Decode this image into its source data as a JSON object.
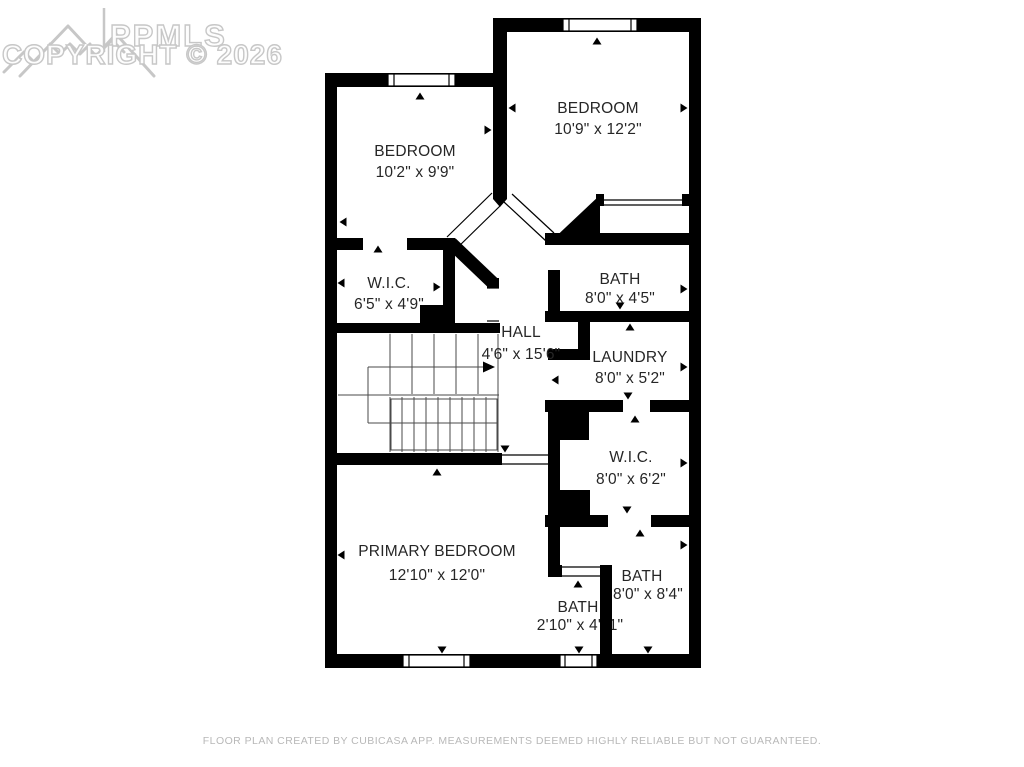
{
  "watermark": {
    "brand": "PPMLS",
    "copyright": "COPYRIGHT © 2026"
  },
  "rooms": [
    {
      "id": "bedroom-top-right",
      "name": "BEDROOM",
      "dimensions": "10'9\" x 12'2\""
    },
    {
      "id": "bedroom-top-left",
      "name": "BEDROOM",
      "dimensions": "10'2\" x 9'9\""
    },
    {
      "id": "wic-left",
      "name": "W.I.C.",
      "dimensions": "6'5\" x 4'9\""
    },
    {
      "id": "hall",
      "name": "HALL",
      "dimensions": "4'6\" x 15'6\""
    },
    {
      "id": "bath-upper",
      "name": "BATH",
      "dimensions": "8'0\" x 4'5\""
    },
    {
      "id": "laundry",
      "name": "LAUNDRY",
      "dimensions": "8'0\" x 5'2\""
    },
    {
      "id": "wic-right",
      "name": "W.I.C.",
      "dimensions": "8'0\" x 6'2\""
    },
    {
      "id": "primary-bedroom",
      "name": "PRIMARY BEDROOM",
      "dimensions": "12'10\" x 12'0\""
    },
    {
      "id": "bath-lower-right",
      "name": "BATH",
      "dimensions": "8'0\" x 8'4\""
    },
    {
      "id": "bath-small",
      "name": "BATH",
      "dimensions": "2'10\" x 4'11\""
    }
  ],
  "footer": {
    "disclaimer": "FLOOR PLAN CREATED BY CUBICASA APP. MEASUREMENTS DEEMED HIGHLY RELIABLE BUT NOT GUARANTEED."
  },
  "colors": {
    "wall": "#000000",
    "label": "#262626",
    "watermark": "#c5c5c5",
    "footer": "#b8b8b8"
  }
}
